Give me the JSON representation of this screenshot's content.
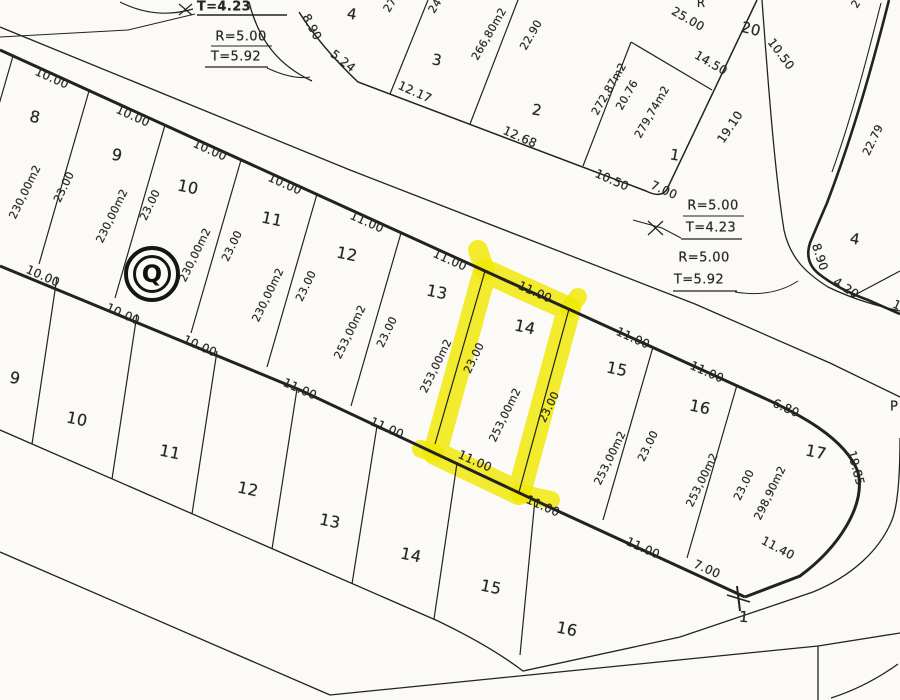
{
  "map": {
    "type_note": "scanned cadastral plat",
    "highlighted_lot": "14",
    "block_marker": {
      "letter": "Q"
    },
    "colors": {
      "paper": "#fbfaf6",
      "ink": "#222222",
      "highlight": "#f0e800"
    },
    "labels": [
      {
        "t": "10.00",
        "x": 52,
        "y": 78,
        "r": 24,
        "s": 12,
        "n": "frontage-dim"
      },
      {
        "t": "10.00",
        "x": 133,
        "y": 116,
        "r": 24,
        "s": 12,
        "n": "frontage-dim"
      },
      {
        "t": "10.00",
        "x": 210,
        "y": 150,
        "r": 24,
        "s": 12,
        "n": "frontage-dim"
      },
      {
        "t": "10.00",
        "x": 285,
        "y": 184,
        "r": 24,
        "s": 12,
        "n": "frontage-dim"
      },
      {
        "t": "11.00",
        "x": 367,
        "y": 222,
        "r": 24,
        "s": 12,
        "n": "frontage-dim"
      },
      {
        "t": "11.00",
        "x": 450,
        "y": 260,
        "r": 24,
        "s": 12,
        "n": "frontage-dim"
      },
      {
        "t": "11.00",
        "x": 535,
        "y": 292,
        "r": 24,
        "s": 12,
        "n": "frontage-dim-lot14-top"
      },
      {
        "t": "11.00",
        "x": 633,
        "y": 338,
        "r": 24,
        "s": 12,
        "n": "frontage-dim"
      },
      {
        "t": "11.00",
        "x": 707,
        "y": 372,
        "r": 24,
        "s": 12,
        "n": "frontage-dim"
      },
      {
        "t": "6.80",
        "x": 786,
        "y": 408,
        "r": 24,
        "s": 12,
        "n": "frontage-dim"
      },
      {
        "t": "19.85",
        "x": 856,
        "y": 468,
        "r": 75,
        "s": 12,
        "n": "curve-length-dim"
      },
      {
        "t": "11.40",
        "x": 778,
        "y": 548,
        "r": 28,
        "s": 12,
        "n": "frontage-dim"
      },
      {
        "t": "10.00",
        "x": 43,
        "y": 276,
        "r": 24,
        "s": 12,
        "n": "frontage-dim"
      },
      {
        "t": "10.00",
        "x": 123,
        "y": 314,
        "r": 24,
        "s": 12,
        "n": "frontage-dim"
      },
      {
        "t": "10.00",
        "x": 200,
        "y": 346,
        "r": 24,
        "s": 12,
        "n": "frontage-dim"
      },
      {
        "t": "11.00",
        "x": 300,
        "y": 389,
        "r": 24,
        "s": 12,
        "n": "frontage-dim"
      },
      {
        "t": "11.00",
        "x": 387,
        "y": 428,
        "r": 24,
        "s": 12,
        "n": "frontage-dim"
      },
      {
        "t": "11.00",
        "x": 475,
        "y": 461,
        "r": 24,
        "s": 12,
        "n": "frontage-dim-lot14-bottom"
      },
      {
        "t": "11.00",
        "x": 543,
        "y": 506,
        "r": 24,
        "s": 12,
        "n": "frontage-dim"
      },
      {
        "t": "11.00",
        "x": 643,
        "y": 548,
        "r": 24,
        "s": 12,
        "n": "frontage-dim"
      },
      {
        "t": "7.00",
        "x": 707,
        "y": 569,
        "r": 24,
        "s": 12,
        "n": "frontage-dim"
      },
      {
        "t": "8",
        "x": 35,
        "y": 117,
        "r": 12,
        "s": 16,
        "n": "lot-number"
      },
      {
        "t": "9",
        "x": 117,
        "y": 155,
        "r": 12,
        "s": 16,
        "n": "lot-number"
      },
      {
        "t": "10",
        "x": 188,
        "y": 187,
        "r": 12,
        "s": 16,
        "n": "lot-number"
      },
      {
        "t": "11",
        "x": 272,
        "y": 219,
        "r": 12,
        "s": 16,
        "n": "lot-number"
      },
      {
        "t": "12",
        "x": 347,
        "y": 254,
        "r": 12,
        "s": 16,
        "n": "lot-number"
      },
      {
        "t": "13",
        "x": 437,
        "y": 292,
        "r": 12,
        "s": 16,
        "n": "lot-number"
      },
      {
        "t": "14",
        "x": 525,
        "y": 327,
        "r": 12,
        "s": 16,
        "n": "lot-number-highlighted"
      },
      {
        "t": "15",
        "x": 617,
        "y": 369,
        "r": 12,
        "s": 16,
        "n": "lot-number"
      },
      {
        "t": "16",
        "x": 700,
        "y": 407,
        "r": 12,
        "s": 16,
        "n": "lot-number"
      },
      {
        "t": "17",
        "x": 816,
        "y": 452,
        "r": 12,
        "s": 16,
        "n": "lot-number"
      },
      {
        "t": "230,00m2",
        "x": 25,
        "y": 192,
        "r": -64,
        "s": 11,
        "n": "lot-area"
      },
      {
        "t": "23.00",
        "x": 64,
        "y": 187,
        "r": -64,
        "s": 11,
        "n": "depth-dim"
      },
      {
        "t": "230,00m2",
        "x": 112,
        "y": 216,
        "r": -64,
        "s": 11,
        "n": "lot-area"
      },
      {
        "t": "23.00",
        "x": 150,
        "y": 205,
        "r": -64,
        "s": 11,
        "n": "depth-dim"
      },
      {
        "t": "230,00m2",
        "x": 195,
        "y": 255,
        "r": -64,
        "s": 11,
        "n": "lot-area"
      },
      {
        "t": "23.00",
        "x": 232,
        "y": 246,
        "r": -64,
        "s": 11,
        "n": "depth-dim"
      },
      {
        "t": "230,00m2",
        "x": 268,
        "y": 295,
        "r": -64,
        "s": 11,
        "n": "lot-area"
      },
      {
        "t": "23.00",
        "x": 306,
        "y": 286,
        "r": -64,
        "s": 11,
        "n": "depth-dim"
      },
      {
        "t": "253,00m2",
        "x": 350,
        "y": 332,
        "r": -64,
        "s": 11,
        "n": "lot-area"
      },
      {
        "t": "23.00",
        "x": 387,
        "y": 332,
        "r": -64,
        "s": 11,
        "n": "depth-dim"
      },
      {
        "t": "253,00m2",
        "x": 436,
        "y": 366,
        "r": -64,
        "s": 11,
        "n": "lot-area"
      },
      {
        "t": "23.00",
        "x": 474,
        "y": 358,
        "r": -64,
        "s": 11,
        "n": "depth-dim"
      },
      {
        "t": "253,00m2",
        "x": 505,
        "y": 415,
        "r": -64,
        "s": 11,
        "n": "lot-area-lot14"
      },
      {
        "t": "23.00",
        "x": 549,
        "y": 407,
        "r": -64,
        "s": 11,
        "n": "depth-dim-lot14"
      },
      {
        "t": "253,00m2",
        "x": 610,
        "y": 458,
        "r": -64,
        "s": 11,
        "n": "lot-area"
      },
      {
        "t": "23.00",
        "x": 648,
        "y": 446,
        "r": -64,
        "s": 11,
        "n": "depth-dim"
      },
      {
        "t": "253,00m2",
        "x": 702,
        "y": 480,
        "r": -64,
        "s": 11,
        "n": "lot-area"
      },
      {
        "t": "23.00",
        "x": 744,
        "y": 485,
        "r": -64,
        "s": 11,
        "n": "depth-dim"
      },
      {
        "t": "298,90m2",
        "x": 770,
        "y": 493,
        "r": -64,
        "s": 11,
        "n": "lot-area"
      },
      {
        "t": "9",
        "x": 15,
        "y": 378,
        "r": 12,
        "s": 16,
        "n": "lot-number"
      },
      {
        "t": "10",
        "x": 77,
        "y": 419,
        "r": 12,
        "s": 16,
        "n": "lot-number"
      },
      {
        "t": "11",
        "x": 170,
        "y": 452,
        "r": 12,
        "s": 16,
        "n": "lot-number"
      },
      {
        "t": "12",
        "x": 248,
        "y": 489,
        "r": 12,
        "s": 16,
        "n": "lot-number"
      },
      {
        "t": "13",
        "x": 330,
        "y": 521,
        "r": 12,
        "s": 16,
        "n": "lot-number"
      },
      {
        "t": "14",
        "x": 411,
        "y": 555,
        "r": 12,
        "s": 16,
        "n": "lot-number"
      },
      {
        "t": "15",
        "x": 491,
        "y": 587,
        "r": 12,
        "s": 16,
        "n": "lot-number"
      },
      {
        "t": "16",
        "x": 567,
        "y": 629,
        "r": 12,
        "s": 16,
        "n": "lot-number"
      },
      {
        "t": "1",
        "x": 744,
        "y": 617,
        "r": 5,
        "s": 15,
        "n": "corner-point-number"
      },
      {
        "t": "4",
        "x": 352,
        "y": 14,
        "r": 10,
        "s": 15,
        "n": "lot-number"
      },
      {
        "t": "3",
        "x": 437,
        "y": 60,
        "r": 10,
        "s": 15,
        "n": "lot-number"
      },
      {
        "t": "2",
        "x": 537,
        "y": 110,
        "r": 10,
        "s": 15,
        "n": "lot-number"
      },
      {
        "t": "1",
        "x": 675,
        "y": 155,
        "r": 10,
        "s": 15,
        "n": "lot-number"
      },
      {
        "t": "20",
        "x": 751,
        "y": 29,
        "r": 14,
        "s": 15,
        "n": "lot-number"
      },
      {
        "t": "12.17",
        "x": 415,
        "y": 92,
        "r": 24,
        "s": 12,
        "n": "frontage-dim"
      },
      {
        "t": "12.68",
        "x": 520,
        "y": 137,
        "r": 24,
        "s": 12,
        "n": "frontage-dim"
      },
      {
        "t": "10.50",
        "x": 612,
        "y": 180,
        "r": 24,
        "s": 12,
        "n": "frontage-dim"
      },
      {
        "t": "7.00",
        "x": 664,
        "y": 190,
        "r": 24,
        "s": 12,
        "n": "frontage-dim"
      },
      {
        "t": "5.24",
        "x": 343,
        "y": 61,
        "r": 38,
        "s": 12,
        "n": "curve-dim"
      },
      {
        "t": "8.90",
        "x": 312,
        "y": 27,
        "r": 62,
        "s": 12,
        "n": "curve-dim"
      },
      {
        "t": "25.00",
        "x": 688,
        "y": 19,
        "r": 30,
        "s": 12,
        "n": "boundary-dim"
      },
      {
        "t": "14.50",
        "x": 711,
        "y": 63,
        "r": 30,
        "s": 12,
        "n": "boundary-dim"
      },
      {
        "t": "10.50",
        "x": 781,
        "y": 54,
        "r": 53,
        "s": 12,
        "n": "boundary-dim"
      },
      {
        "t": "19.10",
        "x": 730,
        "y": 127,
        "r": -56,
        "s": 12,
        "n": "boundary-dim"
      },
      {
        "t": "266,80m2",
        "x": 489,
        "y": 34,
        "r": -60,
        "s": 11,
        "n": "lot-area"
      },
      {
        "t": "22.90",
        "x": 531,
        "y": 35,
        "r": -60,
        "s": 11,
        "n": "depth-dim"
      },
      {
        "t": "272,87m2",
        "x": 609,
        "y": 89,
        "r": -60,
        "s": 11,
        "n": "lot-area"
      },
      {
        "t": "20.76",
        "x": 627,
        "y": 95,
        "r": -60,
        "s": 11,
        "n": "depth-dim"
      },
      {
        "t": "279,74m2",
        "x": 652,
        "y": 112,
        "r": -60,
        "s": 11,
        "n": "lot-area"
      },
      {
        "t": "27",
        "x": 390,
        "y": 5,
        "r": -58,
        "s": 11,
        "n": "partial-label"
      },
      {
        "t": "24",
        "x": 435,
        "y": 6,
        "r": -58,
        "s": 11,
        "n": "partial-label"
      },
      {
        "t": "R",
        "x": 701,
        "y": 3,
        "r": 0,
        "s": 12,
        "n": "partial-label"
      },
      {
        "t": "2",
        "x": 856,
        "y": 4,
        "r": -58,
        "s": 11,
        "n": "partial-label"
      },
      {
        "t": "4",
        "x": 855,
        "y": 239,
        "r": 10,
        "s": 15,
        "n": "lot-number"
      },
      {
        "t": "8.90",
        "x": 820,
        "y": 257,
        "r": 72,
        "s": 12,
        "n": "curve-dim"
      },
      {
        "t": "4.20",
        "x": 846,
        "y": 288,
        "r": 33,
        "s": 12,
        "n": "frontage-dim"
      },
      {
        "t": "22.79",
        "x": 873,
        "y": 140,
        "r": -64,
        "s": 11,
        "n": "boundary-dim"
      },
      {
        "t": "1",
        "x": 897,
        "y": 305,
        "r": 24,
        "s": 12,
        "n": "partial-label"
      },
      {
        "t": "P",
        "x": 894,
        "y": 407,
        "r": 0,
        "s": 13,
        "n": "partial-label"
      },
      {
        "t": "T=4.23",
        "x": 224,
        "y": 7,
        "r": 0,
        "s": 13,
        "b": true,
        "n": "curve-note"
      },
      {
        "t": "R=5.00",
        "x": 241,
        "y": 37,
        "r": 0,
        "s": 13,
        "n": "curve-note"
      },
      {
        "t": "T=5.92",
        "x": 236,
        "y": 57,
        "r": 0,
        "s": 13,
        "n": "curve-note"
      },
      {
        "t": "R=5.00",
        "x": 713,
        "y": 206,
        "r": 0,
        "s": 13,
        "n": "curve-note"
      },
      {
        "t": "T=4.23",
        "x": 711,
        "y": 228,
        "r": 0,
        "s": 13,
        "n": "curve-note"
      },
      {
        "t": "R=5.00",
        "x": 704,
        "y": 258,
        "r": 0,
        "s": 13,
        "n": "curve-note"
      },
      {
        "t": "T=5.92",
        "x": 699,
        "y": 280,
        "r": 0,
        "s": 13,
        "n": "curve-note"
      }
    ]
  }
}
